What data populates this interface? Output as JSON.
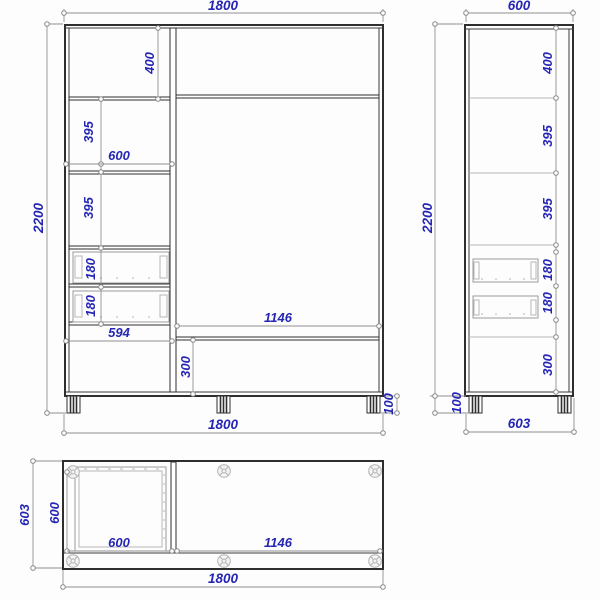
{
  "drawing_title": "wardrobe-three-view-dimension-drawing",
  "front_view": {
    "dims": {
      "width_top": "1800",
      "height": "2200",
      "top_section": "400",
      "section2": "395",
      "left_width": "600",
      "section3": "395",
      "drawer1": "180",
      "drawer2": "180",
      "bottom_left_width": "594",
      "opening_width": "1146",
      "bottom_section": "300",
      "leg_height": "100",
      "width_bottom": "1800"
    }
  },
  "side_view": {
    "dims": {
      "depth_top": "600",
      "height": "2200",
      "top_section": "400",
      "section2": "395",
      "section3": "395",
      "drawer1": "180",
      "drawer2": "180",
      "bottom_section": "300",
      "leg_height": "100",
      "depth_bottom": "603"
    }
  },
  "top_view": {
    "dims": {
      "depth_outer": "603",
      "depth_inner": "600",
      "left_width": "600",
      "opening_width": "1146",
      "width": "1800"
    }
  },
  "colors": {
    "dimension_text": "#2626b4",
    "outline": "#2e2e2e",
    "dimension_line": "#909090",
    "light_detail": "#b6b6b6",
    "background": "#fdfdfd"
  }
}
